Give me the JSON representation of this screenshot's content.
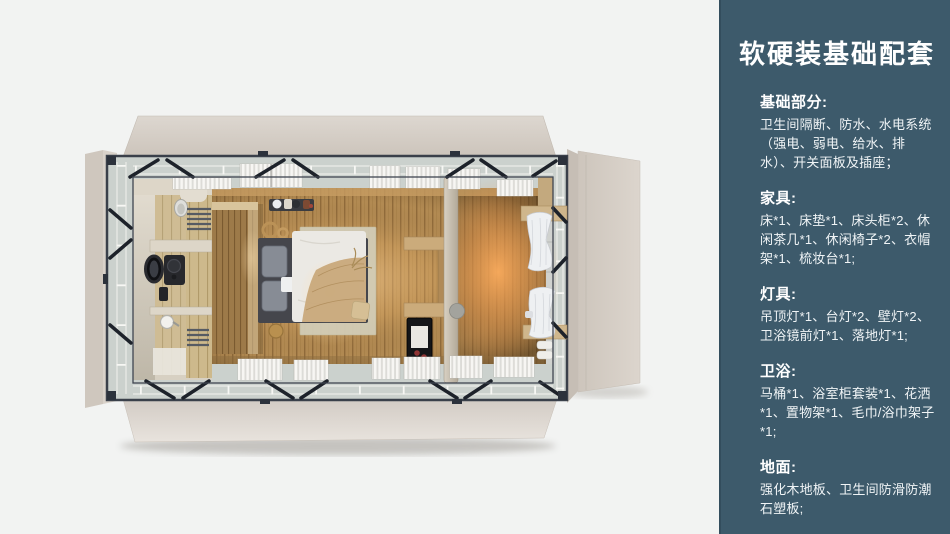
{
  "sidebar": {
    "title": "软硬装基础配套",
    "background_color": "#3d5a6b",
    "text_color": "#ffffff",
    "sections": [
      {
        "heading": "基础部分:",
        "body": "卫生间隔断、防水、水电系统（强电、弱电、给水、排水）、开关面板及插座；"
      },
      {
        "heading": "家具:",
        "body": "床*1、床垫*1、床头柜*2、休闲茶几*1、休闲椅子*2、衣帽架*1、梳妆台*1;"
      },
      {
        "heading": "灯具:",
        "body": "吊顶灯*1、台灯*2、壁灯*2、卫浴镜前灯*1、落地灯*1;"
      },
      {
        "heading": "卫浴:",
        "body": "马桶*1、浴室柜套装*1、花洒*1、置物架*1、毛巾/浴巾架子*1;"
      },
      {
        "heading": "地面:",
        "body": "强化木地板、卫生间防滑防潮石塑板;"
      }
    ]
  },
  "floor_plan": {
    "background_color": "#f2f3f2",
    "panel_color": "#d6cfc7",
    "floor_color": "#b28a52",
    "glow_color": "#f0a95c",
    "frame_color": "#3a404a",
    "elements": [
      "fold-out-panels",
      "perimeter-frame",
      "glass-walkway",
      "bathroom",
      "toilet",
      "vanity-mirror",
      "vanity-cabinet",
      "shower",
      "towel-racks",
      "headboard-wall",
      "double-bed",
      "rug",
      "coat-rack",
      "wall-shelves",
      "magazine-rack",
      "wardrobe-partition",
      "curtains",
      "window-blinds"
    ]
  }
}
